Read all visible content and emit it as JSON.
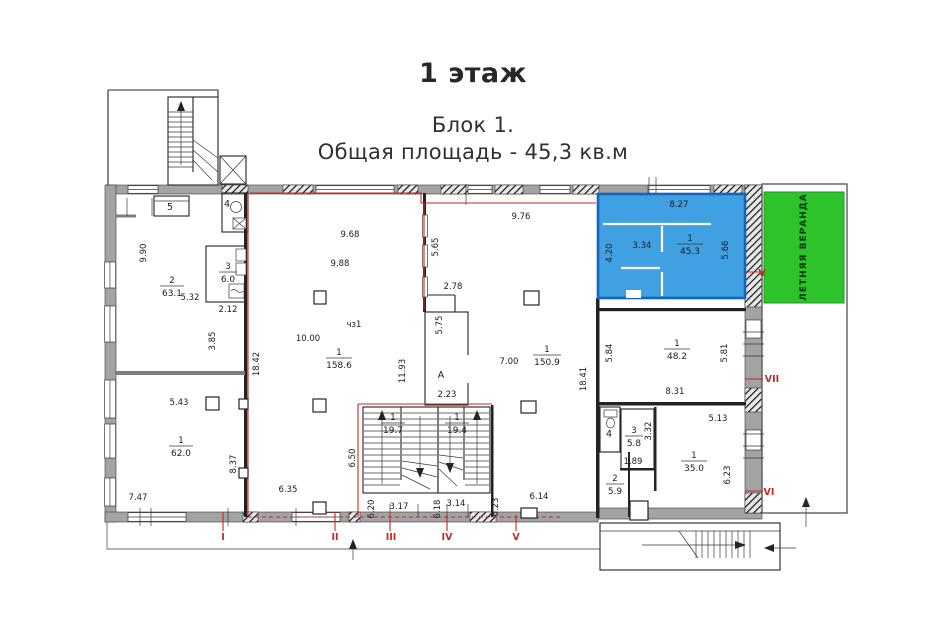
{
  "title": {
    "floor": "1 этаж",
    "block": "Блок 1.",
    "area_line": "Общая площадь - 45,3 кв.м"
  },
  "veranda_label": "ЛЕТНЯЯ ВЕРАНДА",
  "colors": {
    "block_blue": "#3FA0E2",
    "block_blue_border": "#1565BF",
    "veranda_green": "#2EC32A",
    "marker_red": "#C22B25"
  },
  "rooms": {
    "r5": {
      "label": "5"
    },
    "r4_top": {
      "label": "4"
    },
    "r2_left": {
      "num": "2",
      "area": "63.1"
    },
    "r3_left": {
      "num": "3",
      "area": "6.0"
    },
    "r1_left": {
      "num": "1",
      "area": "62.0"
    },
    "r1_center": {
      "num": "1",
      "area": "158.6"
    },
    "r_ch": {
      "label": "чз1"
    },
    "rA": {
      "label": "А"
    },
    "r1_right": {
      "num": "1",
      "area": "150.9"
    },
    "r1_block": {
      "num": "1",
      "area": "45.3"
    },
    "r1_48": {
      "num": "1",
      "area": "48.2"
    },
    "stair1": {
      "num": "1",
      "area": "19.7"
    },
    "stair2": {
      "num": "1",
      "area": "19.4"
    },
    "r4_wc": {
      "label": "4"
    },
    "r3_58": {
      "num": "3",
      "area": "5.8"
    },
    "r2_59": {
      "num": "2",
      "area": "5.9"
    },
    "r1_35": {
      "num": "1",
      "area": "35.0"
    }
  },
  "dims": {
    "d990": "9.90",
    "d532": "5.32",
    "d212": "2.12",
    "d385": "3.85",
    "d1842": "18.42",
    "d543": "5.43",
    "d837": "8.37",
    "d747": "7.47",
    "d968": "9.68",
    "d988": "9.88",
    "d1000": "10.00",
    "d1193": "11.93",
    "d650": "6.50",
    "d635": "6.35",
    "d620": "6.20",
    "d317": "3.17",
    "d618": "6.18",
    "d314": "3.14",
    "d623a": "6.23",
    "d614": "6.14",
    "d278": "2.78",
    "d575": "5.75",
    "d565": "5.65",
    "d223": "2.23",
    "d976": "9.76",
    "d700": "7.00",
    "d1841": "18.41",
    "d827": "8.27",
    "d420": "4.20",
    "d334": "3.34",
    "d566": "5.66",
    "d584": "5.84",
    "d581": "5.81",
    "d831": "8.31",
    "d513": "5.13",
    "d332": "3.32",
    "d189": "1.89",
    "d623b": "6.23"
  },
  "markers": {
    "i": "I",
    "ii": "II",
    "iii": "III",
    "iv": "IV",
    "v": "V",
    "vi": "VI",
    "vii": "VII",
    "v_right": "V"
  }
}
